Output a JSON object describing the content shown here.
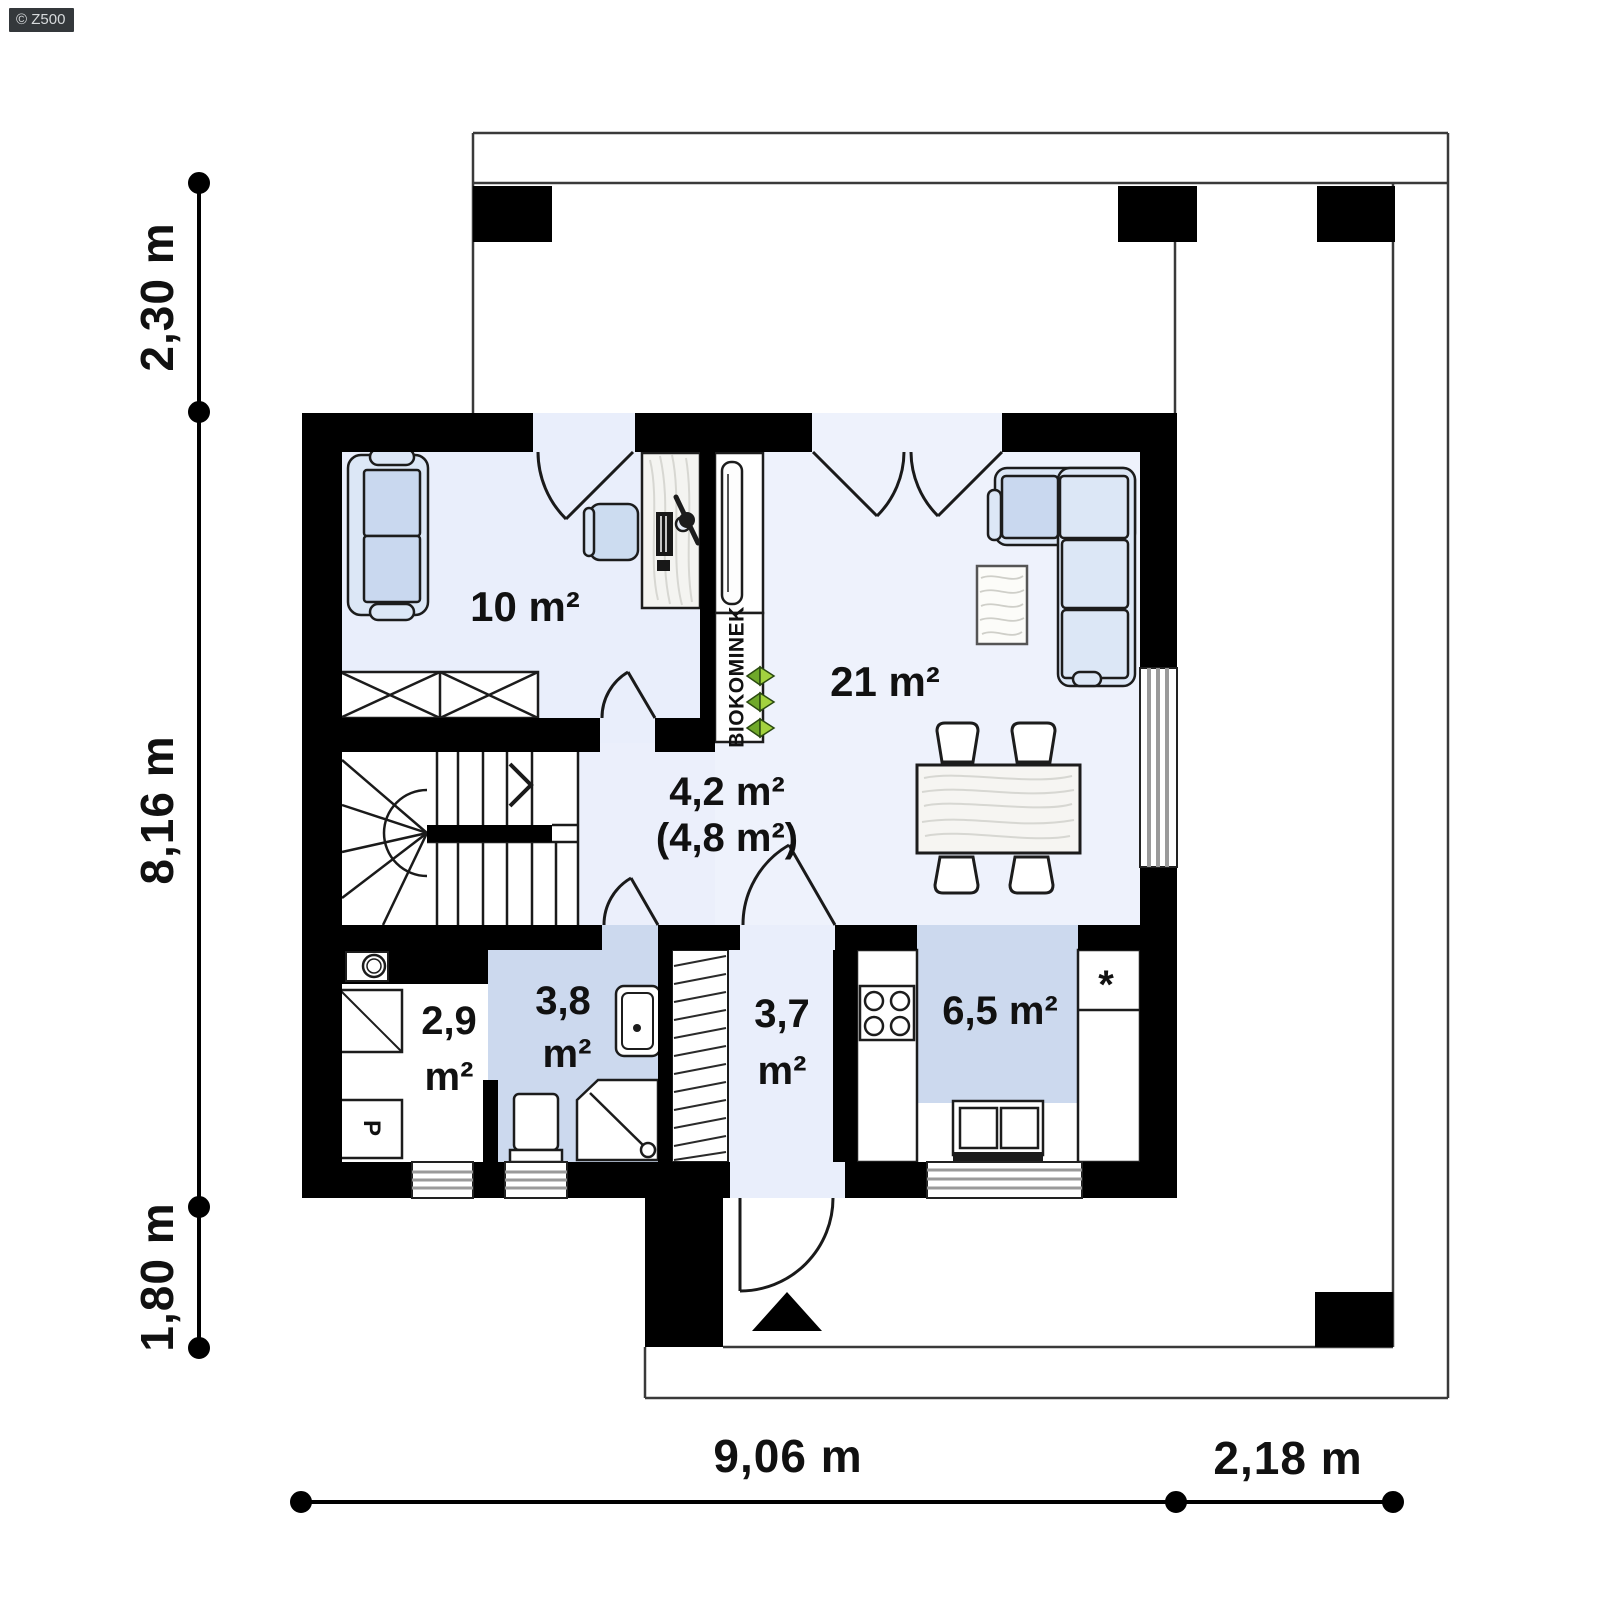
{
  "watermark": {
    "text": "© Z500"
  },
  "dimensions": {
    "left_230": "2,30 m",
    "left_816": "8,16 m",
    "left_180": "1,80 m",
    "bottom_906": "9,06 m",
    "bottom_218": "2,18 m"
  },
  "rooms": {
    "office": {
      "area": "10 m²"
    },
    "living": {
      "area": "21 m²"
    },
    "hall": {
      "area_primary": "4,2 m²",
      "area_secondary": "(4,8 m²)"
    },
    "utility": {
      "value": "2,9",
      "unit": "m²"
    },
    "bathroom": {
      "value": "3,8",
      "unit": "m²"
    },
    "vestibule": {
      "value": "3,7",
      "unit": "m²"
    },
    "kitchen": {
      "area": "6,5 m²"
    }
  },
  "labels": {
    "fireplace": "BIOKOMINEK",
    "washing_machine": "P",
    "fridge_marker": "*"
  },
  "colors": {
    "wall": "#000000",
    "floor_light": "#e9eefb",
    "floor_living": "#eef2fc",
    "floor_blue": "#ccd9ee",
    "furniture_blue": "#dce7f6",
    "cushion_blue": "#c9d8ef",
    "leaf_green_dark": "#6fa82a",
    "leaf_green_light": "#a3d23f"
  }
}
